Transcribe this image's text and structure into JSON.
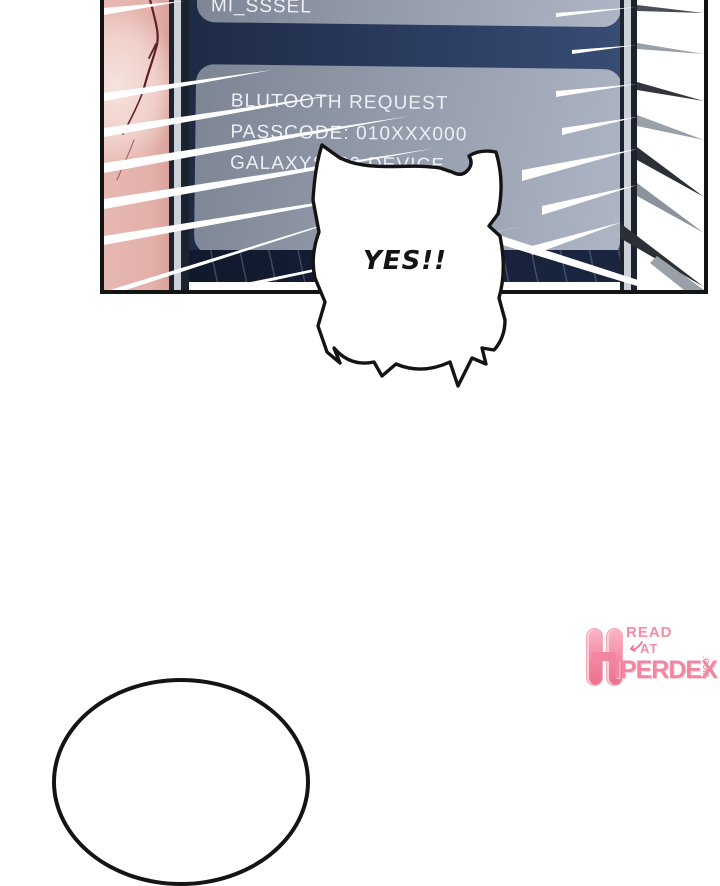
{
  "panel": {
    "phone": {
      "status_text": "MI_SSSEL",
      "notification": {
        "line1": "BLUTOOTH REQUEST",
        "line2": "PASSCODE: 010XXX000",
        "line3": "GALAXYS689 DEVICE"
      }
    }
  },
  "speech_bubble": {
    "text": "YES!!"
  },
  "watermark": {
    "h": "H",
    "read": "READ",
    "at": "AT",
    "iperdex": "IPERDEX",
    "com": ".COM"
  },
  "colors": {
    "screen_navy": "#2b3d60",
    "card_gray": "#98a0b0",
    "skin_pink": "#e7b8b2",
    "watermark_pink": "#f285a0",
    "ink_black": "#141414"
  }
}
